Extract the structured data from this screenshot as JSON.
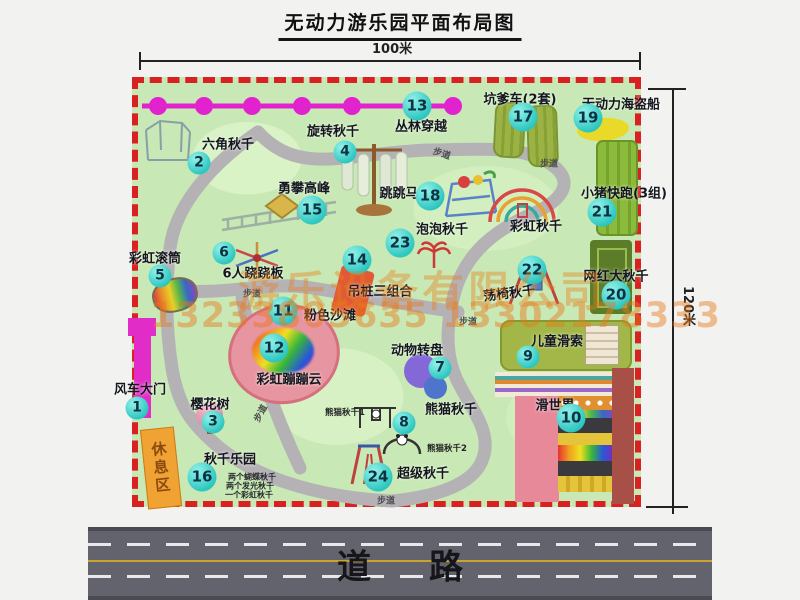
{
  "title": "无动力游乐园平面布局图",
  "dimensions": {
    "width_label": "100米",
    "height_label": "120米"
  },
  "road": {
    "label": "道路"
  },
  "watermark": {
    "company": "游乐设备有限公司",
    "phone": "13233805635 13302178333"
  },
  "park": {
    "rest_area_label": "休息区",
    "path_label": "步道",
    "attractions": [
      {
        "num": 1,
        "name": "风车大门",
        "bubble": {
          "x": 137,
          "y": 408
        },
        "label": {
          "x": 140,
          "y": 388
        }
      },
      {
        "num": 2,
        "name": "六角秋千",
        "bubble": {
          "x": 199,
          "y": 163
        },
        "label": {
          "x": 228,
          "y": 143
        }
      },
      {
        "num": 3,
        "name": "樱花树",
        "bubble": {
          "x": 213,
          "y": 422
        },
        "label": {
          "x": 210,
          "y": 403
        }
      },
      {
        "num": 4,
        "name": "旋转秋千",
        "bubble": {
          "x": 345,
          "y": 152
        },
        "label": {
          "x": 333,
          "y": 130
        }
      },
      {
        "num": 5,
        "name": "彩虹滚筒",
        "bubble": {
          "x": 160,
          "y": 276
        },
        "label": {
          "x": 155,
          "y": 257
        }
      },
      {
        "num": 6,
        "name": "6人跷跷板",
        "bubble": {
          "x": 224,
          "y": 253
        },
        "label": {
          "x": 253,
          "y": 272
        }
      },
      {
        "num": 7,
        "name": "动物转盘",
        "bubble": {
          "x": 440,
          "y": 368
        },
        "label": {
          "x": 417,
          "y": 349
        }
      },
      {
        "num": 8,
        "name": "熊猫秋千",
        "bubble": {
          "x": 404,
          "y": 423
        },
        "label": {
          "x": 451,
          "y": 408
        }
      },
      {
        "num": 9,
        "name": "儿童滑索",
        "bubble": {
          "x": 528,
          "y": 357
        },
        "label": {
          "x": 557,
          "y": 340
        }
      },
      {
        "num": 10,
        "name": "滑世界",
        "bubble": {
          "x": 571,
          "y": 418
        },
        "label": {
          "x": 555,
          "y": 404
        }
      },
      {
        "num": 11,
        "name": "粉色沙滩",
        "bubble": {
          "x": 283,
          "y": 311
        },
        "label": {
          "x": 330,
          "y": 314
        }
      },
      {
        "num": 12,
        "name": "彩虹蹦蹦云",
        "bubble": {
          "x": 274,
          "y": 348
        },
        "label": {
          "x": 289,
          "y": 378
        }
      },
      {
        "num": 13,
        "name": "丛林穿越",
        "bubble": {
          "x": 417,
          "y": 106
        },
        "label": {
          "x": 421,
          "y": 125
        }
      },
      {
        "num": 14,
        "name": "吊桩三组合",
        "bubble": {
          "x": 357,
          "y": 260
        },
        "label": {
          "x": 380,
          "y": 290
        }
      },
      {
        "num": 15,
        "name": "勇攀高峰",
        "bubble": {
          "x": 312,
          "y": 210
        },
        "label": {
          "x": 304,
          "y": 187
        }
      },
      {
        "num": 16,
        "name": "秋千乐园",
        "bubble": {
          "x": 202,
          "y": 477
        },
        "label": {
          "x": 230,
          "y": 458
        }
      },
      {
        "num": 17,
        "name": "坑爹车(2套)",
        "bubble": {
          "x": 523,
          "y": 117
        },
        "label": {
          "x": 520,
          "y": 98
        }
      },
      {
        "num": 18,
        "name": "跳跳马",
        "bubble": {
          "x": 430,
          "y": 196
        },
        "label": {
          "x": 399,
          "y": 192
        }
      },
      {
        "num": 19,
        "name": "无动力海盗船",
        "bubble": {
          "x": 588,
          "y": 118
        },
        "label": {
          "x": 621,
          "y": 103
        }
      },
      {
        "num": 20,
        "name": "网红大秋千",
        "bubble": {
          "x": 616,
          "y": 295
        },
        "label": {
          "x": 616,
          "y": 275
        }
      },
      {
        "num": 21,
        "name": "小猪快跑(3组)",
        "bubble": {
          "x": 602,
          "y": 212
        },
        "label": {
          "x": 624,
          "y": 192
        }
      },
      {
        "num": 22,
        "name": "荡椅秋千",
        "bubble": {
          "x": 532,
          "y": 270
        },
        "label": {
          "x": 509,
          "y": 292,
          "rot": -7
        }
      },
      {
        "num": 23,
        "name": "泡泡秋千",
        "bubble": {
          "x": 400,
          "y": 243
        },
        "label": {
          "x": 442,
          "y": 228
        }
      },
      {
        "num": 24,
        "name": "超级秋千",
        "bubble": {
          "x": 378,
          "y": 477
        },
        "label": {
          "x": 423,
          "y": 472
        }
      }
    ],
    "text_labels": [
      {
        "text": "彩虹秋千",
        "x": 536,
        "y": 225,
        "cls": "alabel"
      },
      {
        "text": "步道",
        "x": 442,
        "y": 153,
        "cls": "plabel",
        "rot": 18
      },
      {
        "text": "步道",
        "x": 549,
        "y": 163,
        "cls": "plabel"
      },
      {
        "text": "步道",
        "x": 252,
        "y": 293,
        "cls": "plabel"
      },
      {
        "text": "步道",
        "x": 468,
        "y": 321,
        "cls": "plabel"
      },
      {
        "text": "步道",
        "x": 386,
        "y": 500,
        "cls": "plabel"
      },
      {
        "text": "步道",
        "x": 260,
        "y": 413,
        "cls": "plabel",
        "rot": -62
      },
      {
        "text": "熊猫秋千1",
        "x": 345,
        "y": 412,
        "cls": "tlabel"
      },
      {
        "text": "熊猫秋千2",
        "x": 447,
        "y": 448,
        "cls": "tlabel"
      },
      {
        "text": "两个蝴蝶秋千",
        "x": 228,
        "y": 477,
        "cls": "llabel"
      },
      {
        "text": "两个发光秋千",
        "x": 226,
        "y": 486,
        "cls": "llabel"
      },
      {
        "text": "一个彩虹秋千",
        "x": 225,
        "y": 495,
        "cls": "llabel"
      }
    ]
  }
}
